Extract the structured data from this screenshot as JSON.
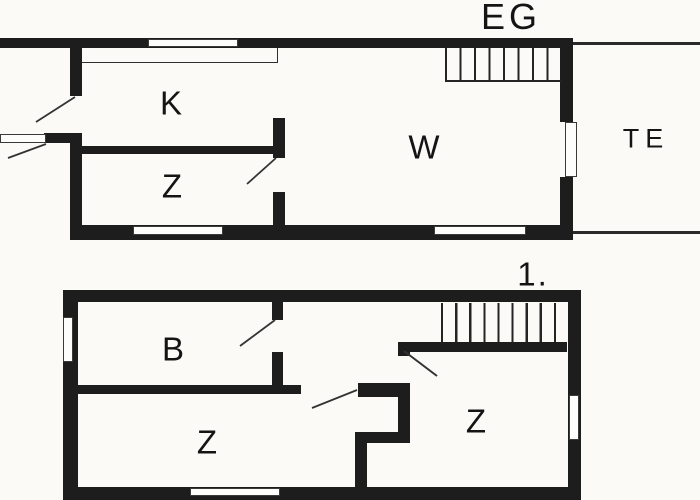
{
  "floors": [
    {
      "name": "EG",
      "rooms": [
        {
          "label": "K"
        },
        {
          "label": "Z"
        },
        {
          "label": "W"
        },
        {
          "label": "TE"
        }
      ]
    },
    {
      "name": "1.",
      "rooms": [
        {
          "label": "B"
        },
        {
          "label": "Z"
        },
        {
          "label": "Z"
        }
      ]
    }
  ],
  "colors": {
    "wall": "#1d1d1d",
    "background": "#fbfaf7",
    "thin_line": "#2a2a2a"
  }
}
